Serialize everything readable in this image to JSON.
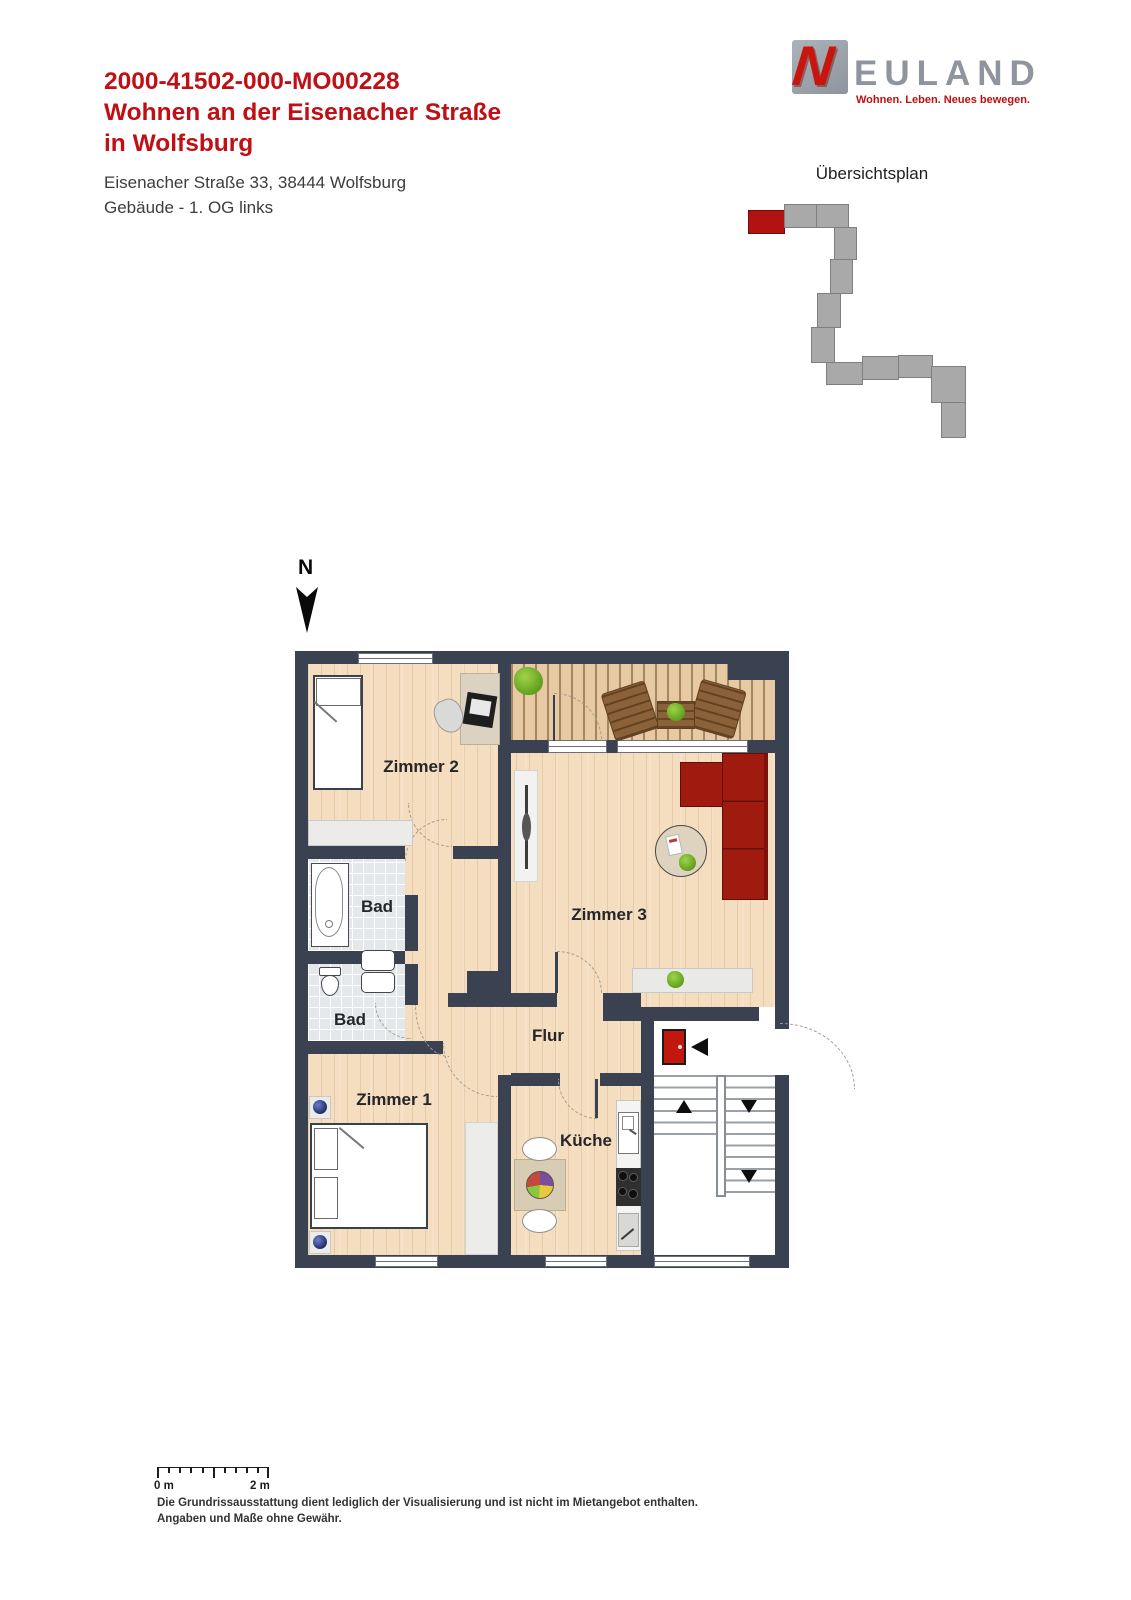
{
  "header": {
    "listing_code": "2000-41502-000-MO00228",
    "title_line1": "Wohnen an der Eisenacher Straße",
    "title_line2": "in Wolfsburg",
    "address": "Eisenacher Straße 33, 38444 Wolfsburg",
    "unit_info": "Gebäude - 1. OG links"
  },
  "logo": {
    "initial": "N",
    "wordmark": "EULAND",
    "tagline": "Wohnen. Leben. Neues bewegen."
  },
  "overview": {
    "title": "Übersichtsplan"
  },
  "compass": {
    "north_label": "N"
  },
  "floorplan": {
    "labels": {
      "zimmer1": "Zimmer 1",
      "zimmer2": "Zimmer 2",
      "zimmer3": "Zimmer 3",
      "bad_top": "Bad",
      "bad_bottom": "Bad",
      "flur": "Flur",
      "kueche": "Küche"
    }
  },
  "scale_bar": {
    "zero_label": "0 m",
    "two_label": "2 m"
  },
  "disclaimer": {
    "line1": "Die Grundrissausstattung dient lediglich der Visualisierung und ist nicht im Mietangebot enthalten.",
    "line2": "Angaben und Maße ohne Gewähr."
  },
  "colors": {
    "accent_red": "#c00f15",
    "wall": "#3a4150",
    "wood_floor": "#f5ddbf",
    "deck": "#e7c9a3",
    "tile": "#e4e8eb",
    "sofa_red": "#9f1b0f",
    "door_red": "#c2170e",
    "logo_gray": "#8e959e",
    "overview_block_gray": "#a9a9a9",
    "overview_highlight_red": "#b31212"
  }
}
